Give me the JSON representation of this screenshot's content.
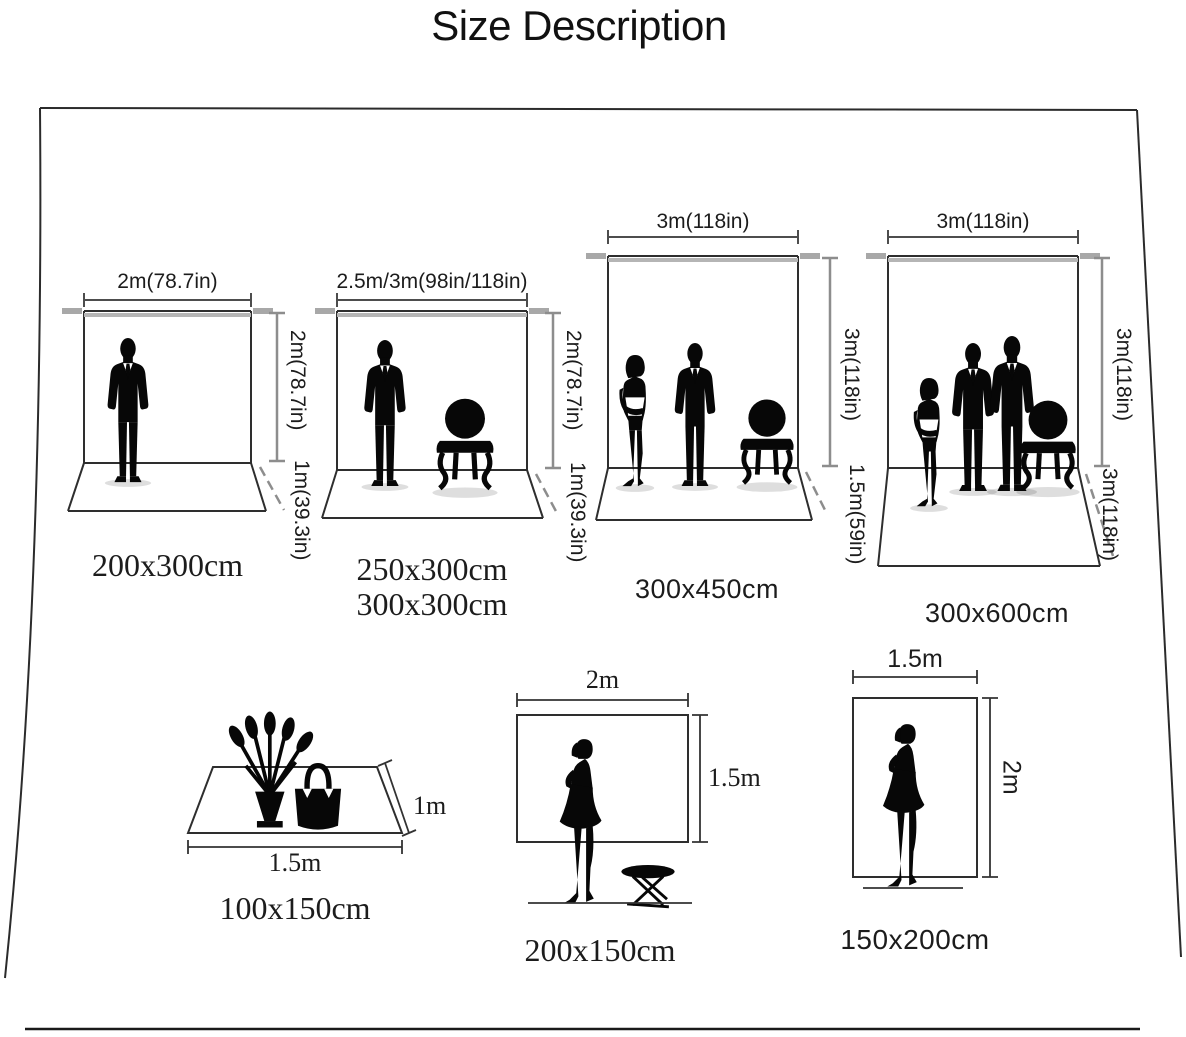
{
  "title": "Size Description",
  "colors": {
    "ink": "#1c1c1c",
    "outline": "#2e2e2e",
    "measure_gray": "#8d8d8d",
    "measure_dark": "#4d4d4d",
    "crossbar": "#b5b5b5",
    "background": "#ffffff"
  },
  "top_row": [
    {
      "name": "backdrop-200x300",
      "width_label": "2m(78.7in)",
      "height_label": "2m(78.7in)",
      "depth_label": "1m(39.3in)",
      "size_label": "200x300cm",
      "figures": [
        "man"
      ]
    },
    {
      "name": "backdrop-250x300-300x300",
      "width_label": "2.5m/3m(98in/118in)",
      "height_label": "2m(78.7in)",
      "depth_label": "1m(39.3in)",
      "size_label": "250x300cm",
      "size_label_2": "300x300cm",
      "figures": [
        "man",
        "chair"
      ]
    },
    {
      "name": "backdrop-300x450",
      "width_label": "3m(118in)",
      "height_label": "3m(118in)",
      "depth_label": "1.5m(59in)",
      "size_label": "300x450cm",
      "figures": [
        "woman",
        "man",
        "chair"
      ]
    },
    {
      "name": "backdrop-300x600",
      "width_label": "3m(118in)",
      "height_label": "3m(118in)",
      "depth_label": "3m(118in)",
      "size_label": "300x600cm",
      "figures": [
        "woman",
        "man",
        "man",
        "chair"
      ]
    }
  ],
  "bottom_row": [
    {
      "name": "rug-100x150",
      "width_label": "1.5m",
      "height_label": "1m",
      "size_label": "100x150cm",
      "figures": [
        "flower-vase",
        "handbag"
      ]
    },
    {
      "name": "backdrop-200x150",
      "width_label": "2m",
      "height_label": "1.5m",
      "size_label": "200x150cm",
      "figures": [
        "woman-dress",
        "folding-stool"
      ]
    },
    {
      "name": "backdrop-150x200",
      "width_label": "1.5m",
      "height_label": "2m",
      "size_label": "150x200cm",
      "figures": [
        "woman-dress"
      ]
    }
  ]
}
